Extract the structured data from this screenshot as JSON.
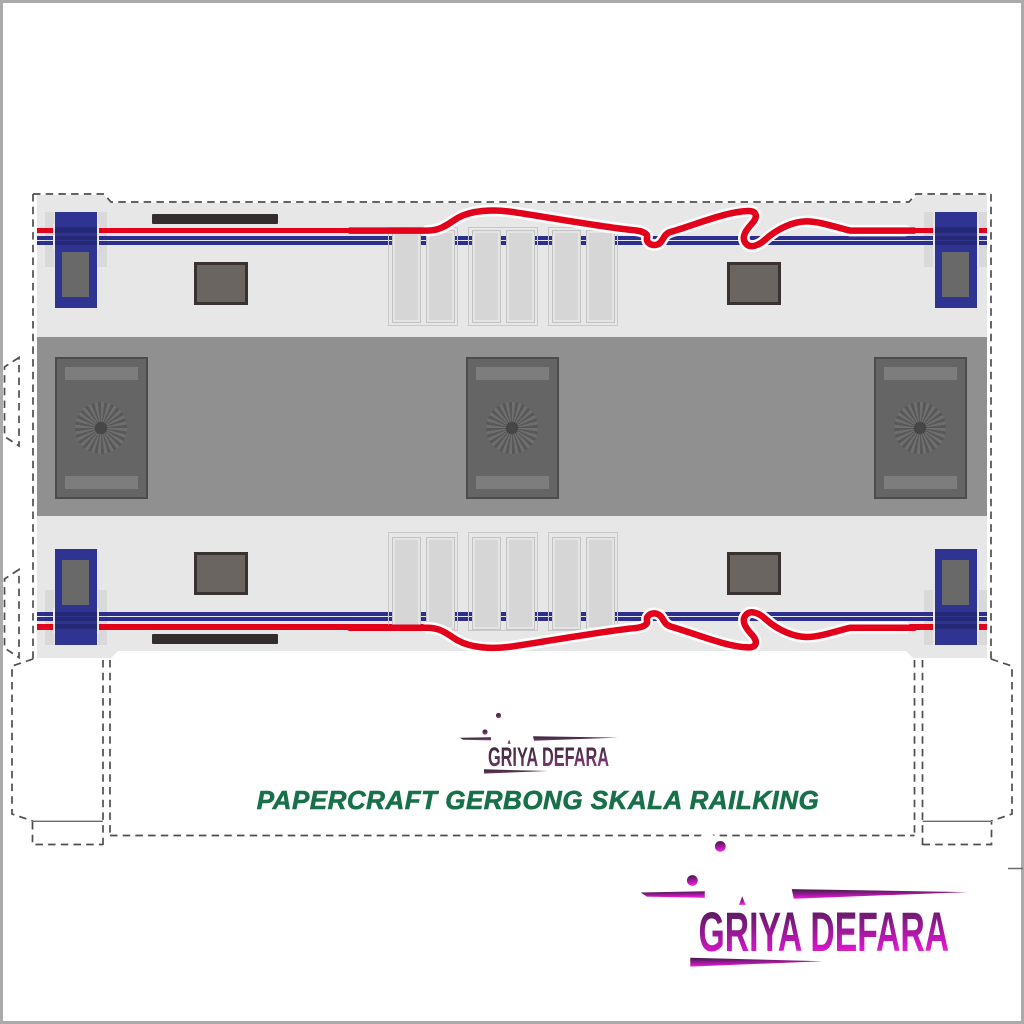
{
  "branding": {
    "logo_text": "GRIYA DEFARA",
    "title": "PAPERCRAFT GERBONG SKALA RAILKING"
  },
  "colors": {
    "body_gray": "#e7e7e7",
    "roof_gray": "#909090",
    "ac_panel_gray": "#656565",
    "door_blue": "#2f3492",
    "stripe_red": "#e2001a",
    "stripe_blue": "#2d2f8f",
    "window_gray": "#6b6561",
    "title_green": "#17704a",
    "logo_magenta": "#ef2ad8",
    "logo_dark_purple": "#3c1b45"
  },
  "parts": {
    "side_panels": 2,
    "doors": 4,
    "windows": 4,
    "roof_fans": 3,
    "vent_slat_groups": 6
  }
}
